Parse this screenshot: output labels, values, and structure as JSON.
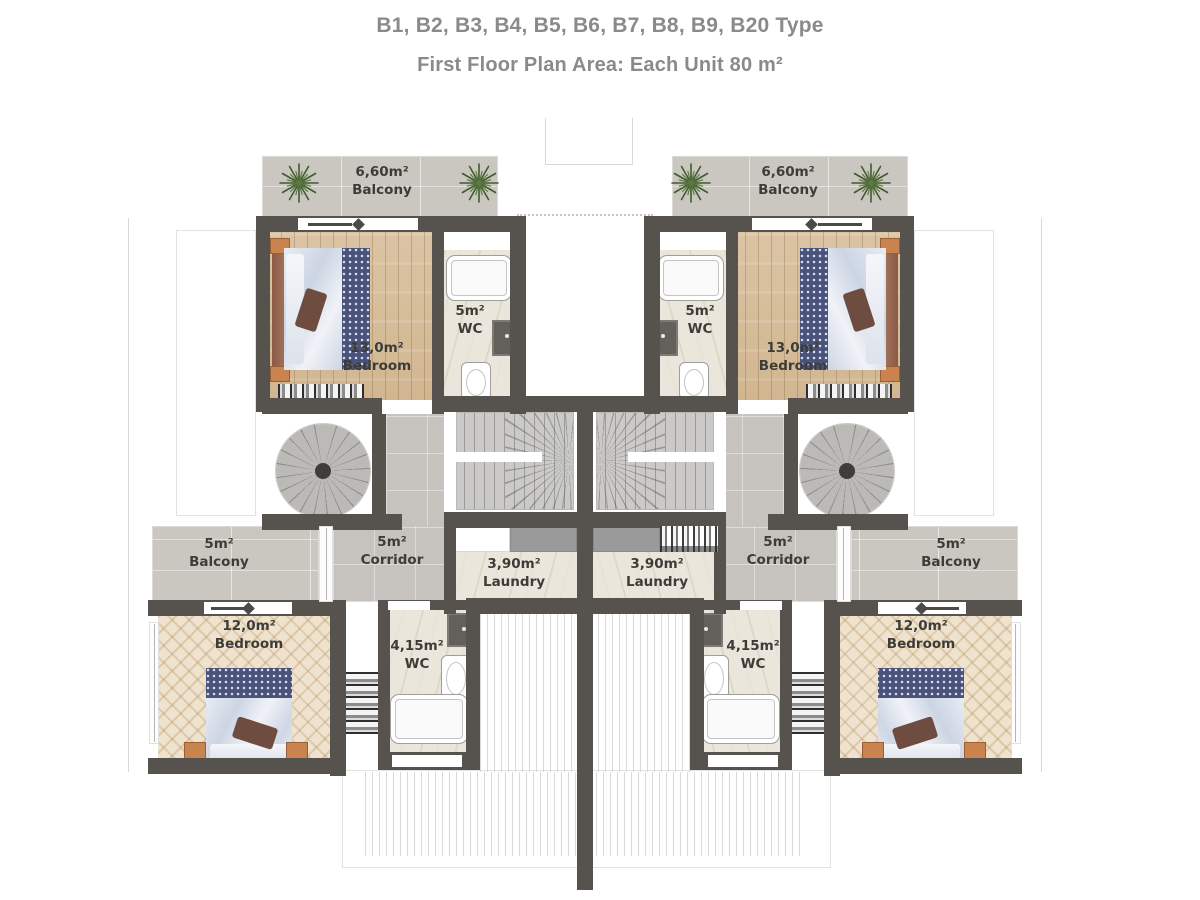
{
  "header": {
    "types_line": "B1, B2, B3, B4, B5, B6, B7, B8, B9, B20 Type",
    "plan_line": "First Floor Plan Area: Each Unit 80 m²"
  },
  "rooms": {
    "balcony_top": {
      "area": "6,60m²",
      "name": "Balcony"
    },
    "bedroom_top": {
      "area": "13,0m²",
      "name": "Bedroom"
    },
    "wc_top": {
      "area": "5m²",
      "name": "WC"
    },
    "corridor": {
      "area": "5m²",
      "name": "Corridor"
    },
    "laundry": {
      "area": "3,90m²",
      "name": "Laundry"
    },
    "wc_bottom": {
      "area": "4,15m²",
      "name": "WC"
    },
    "bedroom_bottom": {
      "area": "12,0m²",
      "name": "Bedroom"
    },
    "balcony_side": {
      "area": "5m²",
      "name": "Balcony"
    }
  },
  "palette": {
    "wall": "#56524d",
    "wood": "#d6bd9b",
    "herringbone": "#e9d8bc",
    "concrete": "#cac7c1",
    "marble": "#ebe6dc",
    "bed_navy": "#49527b",
    "label_text": "#3e3c39",
    "header_text": "#8a8a8a"
  }
}
